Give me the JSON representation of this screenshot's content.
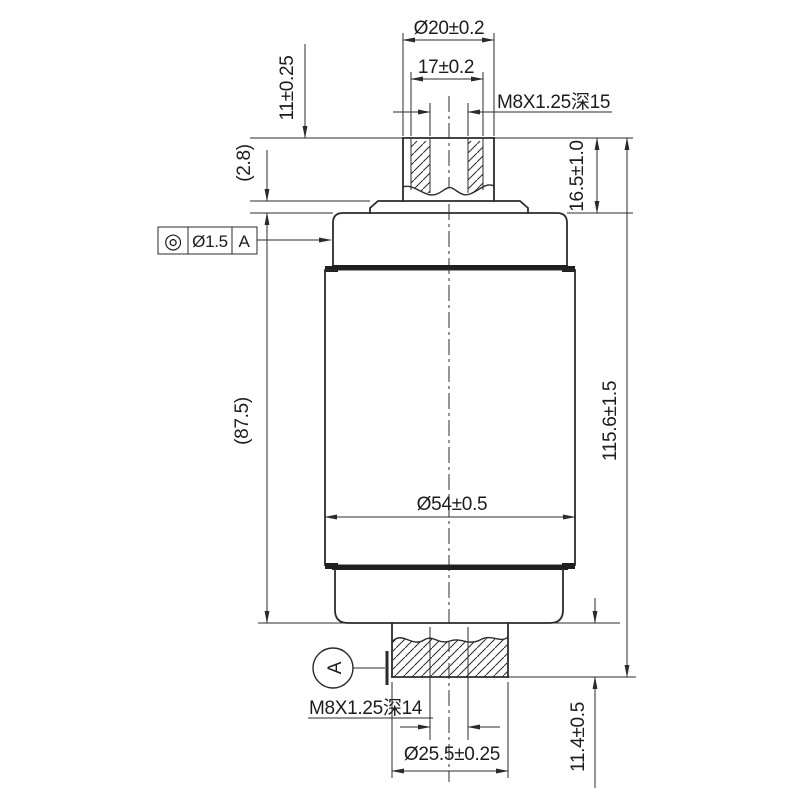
{
  "labels": {
    "top_outer_dia": "Ø20±0.2",
    "top_bore": "17±0.2",
    "top_thread": "M8X1.25深15",
    "boss_height": "11±0.25",
    "step_height": "(2.8)",
    "top_cap_height": "16.5±1.0",
    "fcf_symbol": "◎",
    "fcf_tolerance": "Ø1.5",
    "fcf_datum": "A",
    "body_length_ref": "(87.5)",
    "overall_length": "115.6±1.5",
    "body_dia": "Ø54±0.5",
    "datum_label": "A",
    "bottom_thread": "M8X1.25深14",
    "bottom_stud_dia": "Ø25.5±0.25",
    "bottom_stud_height": "11.4±0.5"
  },
  "colors": {
    "line": "#2b2b2b",
    "background": "#ffffff"
  }
}
